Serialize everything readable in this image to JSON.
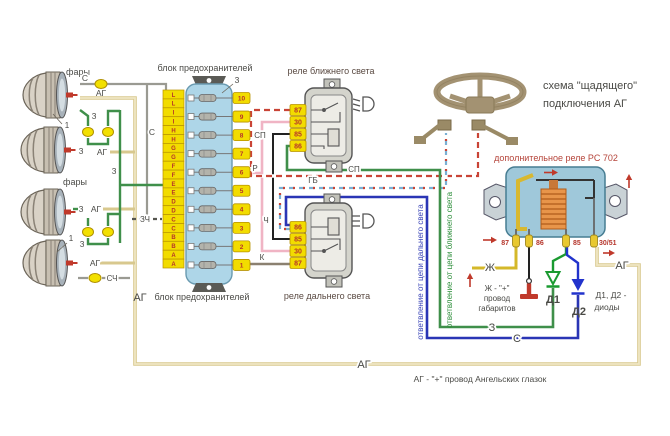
{
  "title": {
    "line1": "схема \"щадящего\"",
    "line2": "подключения АГ"
  },
  "fuse_block": {
    "caption_top": "блок предохранителей",
    "caption_bottom": "блок предохранителей",
    "callout": "3",
    "letters": [
      "L",
      "L",
      "I",
      "I",
      "H",
      "H",
      "G",
      "G",
      "F",
      "F",
      "E",
      "E",
      "D",
      "D",
      "C",
      "C",
      "B",
      "B",
      "A",
      "A"
    ],
    "fuse_numbers": [
      "10",
      "9",
      "8",
      "7",
      "6",
      "5",
      "4",
      "3",
      "2",
      "1"
    ]
  },
  "relays": {
    "low_beam": {
      "caption": "реле ближнего света",
      "terminals": [
        "87",
        "30",
        "85",
        "86"
      ]
    },
    "high_beam": {
      "caption": "реле дальнего света",
      "terminals": [
        "86",
        "85",
        "30",
        "87"
      ]
    },
    "aux": {
      "caption": "дополнительное реле РС 702",
      "terminals": [
        "87",
        "86",
        "85",
        "30/51"
      ]
    }
  },
  "headlights": {
    "caption_upper": "фары",
    "caption_lower": "фары",
    "callout": "1"
  },
  "wire_labels": {
    "s": "С",
    "sch": "СЧ",
    "zch": "ЗЧ",
    "z": "З",
    "ag": "АГ",
    "r": "Р",
    "ch": "Ч",
    "k": "К",
    "sp": "СП",
    "gb": "ГБ",
    "zh": "Ж"
  },
  "branches": {
    "high_beam": "ответвление от цепи дальнего света",
    "low_beam": "ответвление от цепи ближнего света"
  },
  "diodes": {
    "d1": "Д1",
    "d2": "Д2",
    "note1": "Д1, Д2 -",
    "note2": "диоды"
  },
  "notes": {
    "zh1": "Ж - \"+\"",
    "zh2": "провод",
    "zh3": "габаритов",
    "ag_bottom": "АГ - \"+\" провод Ангельских глазок"
  },
  "colors": {
    "wire_green": "#3f8f4a",
    "wire_dark_blue": "#2a35b5",
    "wire_beige": "#e4d6a2",
    "wire_grey": "#9a9a92",
    "wire_pink": "#f0b4c4",
    "wire_black": "#222222",
    "wire_brown": "#8b8070",
    "wire_red_dash": "#c94436",
    "wire_light_blue": "#7ab0d4",
    "wire_yellow": "#d4b82a",
    "terminal_yellow": "#f2dc00",
    "fuse_body_blue": "#aed6e8",
    "aux_relay_blue": "#9fc8da",
    "coil_orange": "#e8954a",
    "accent_red": "#c0392b"
  }
}
